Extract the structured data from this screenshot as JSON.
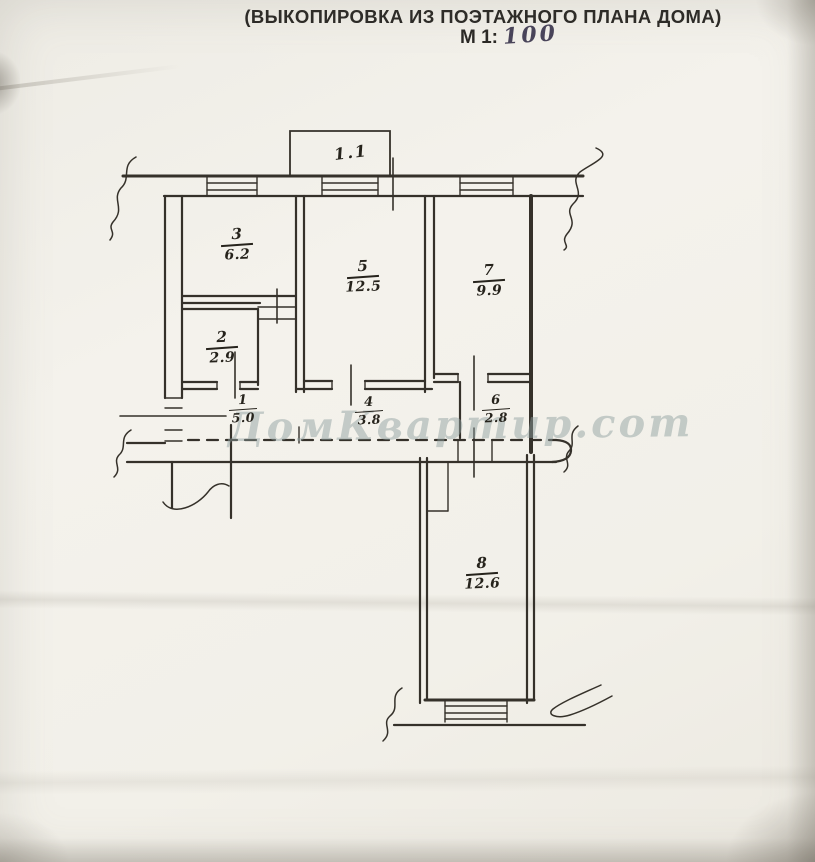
{
  "title": {
    "cutoff_top": "ПЛАН",
    "line1": "(ВЫКОПИРОВКА ИЗ ПОЭТАЖНОГО ПЛАНА ДОМА)",
    "scale_label": "М 1:",
    "scale_value": "100"
  },
  "watermark": "ДомКвартир.com",
  "plan": {
    "balcony_label": "1.1",
    "rooms": [
      {
        "id": "3",
        "area": "6.2"
      },
      {
        "id": "5",
        "area": "12.5"
      },
      {
        "id": "7",
        "area": "9.9"
      },
      {
        "id": "2",
        "area": "2.9"
      },
      {
        "id": "1",
        "area": "5.0"
      },
      {
        "id": "4",
        "area": "3.8"
      },
      {
        "id": "6",
        "area": "2.8"
      },
      {
        "id": "8",
        "area": "12.6"
      }
    ]
  },
  "colors": {
    "paper": "#f2f0e9",
    "ink": "#35312a",
    "handwriting": "#26231c",
    "scale_ink": "#49445a",
    "watermark": "#8f9e9e"
  }
}
